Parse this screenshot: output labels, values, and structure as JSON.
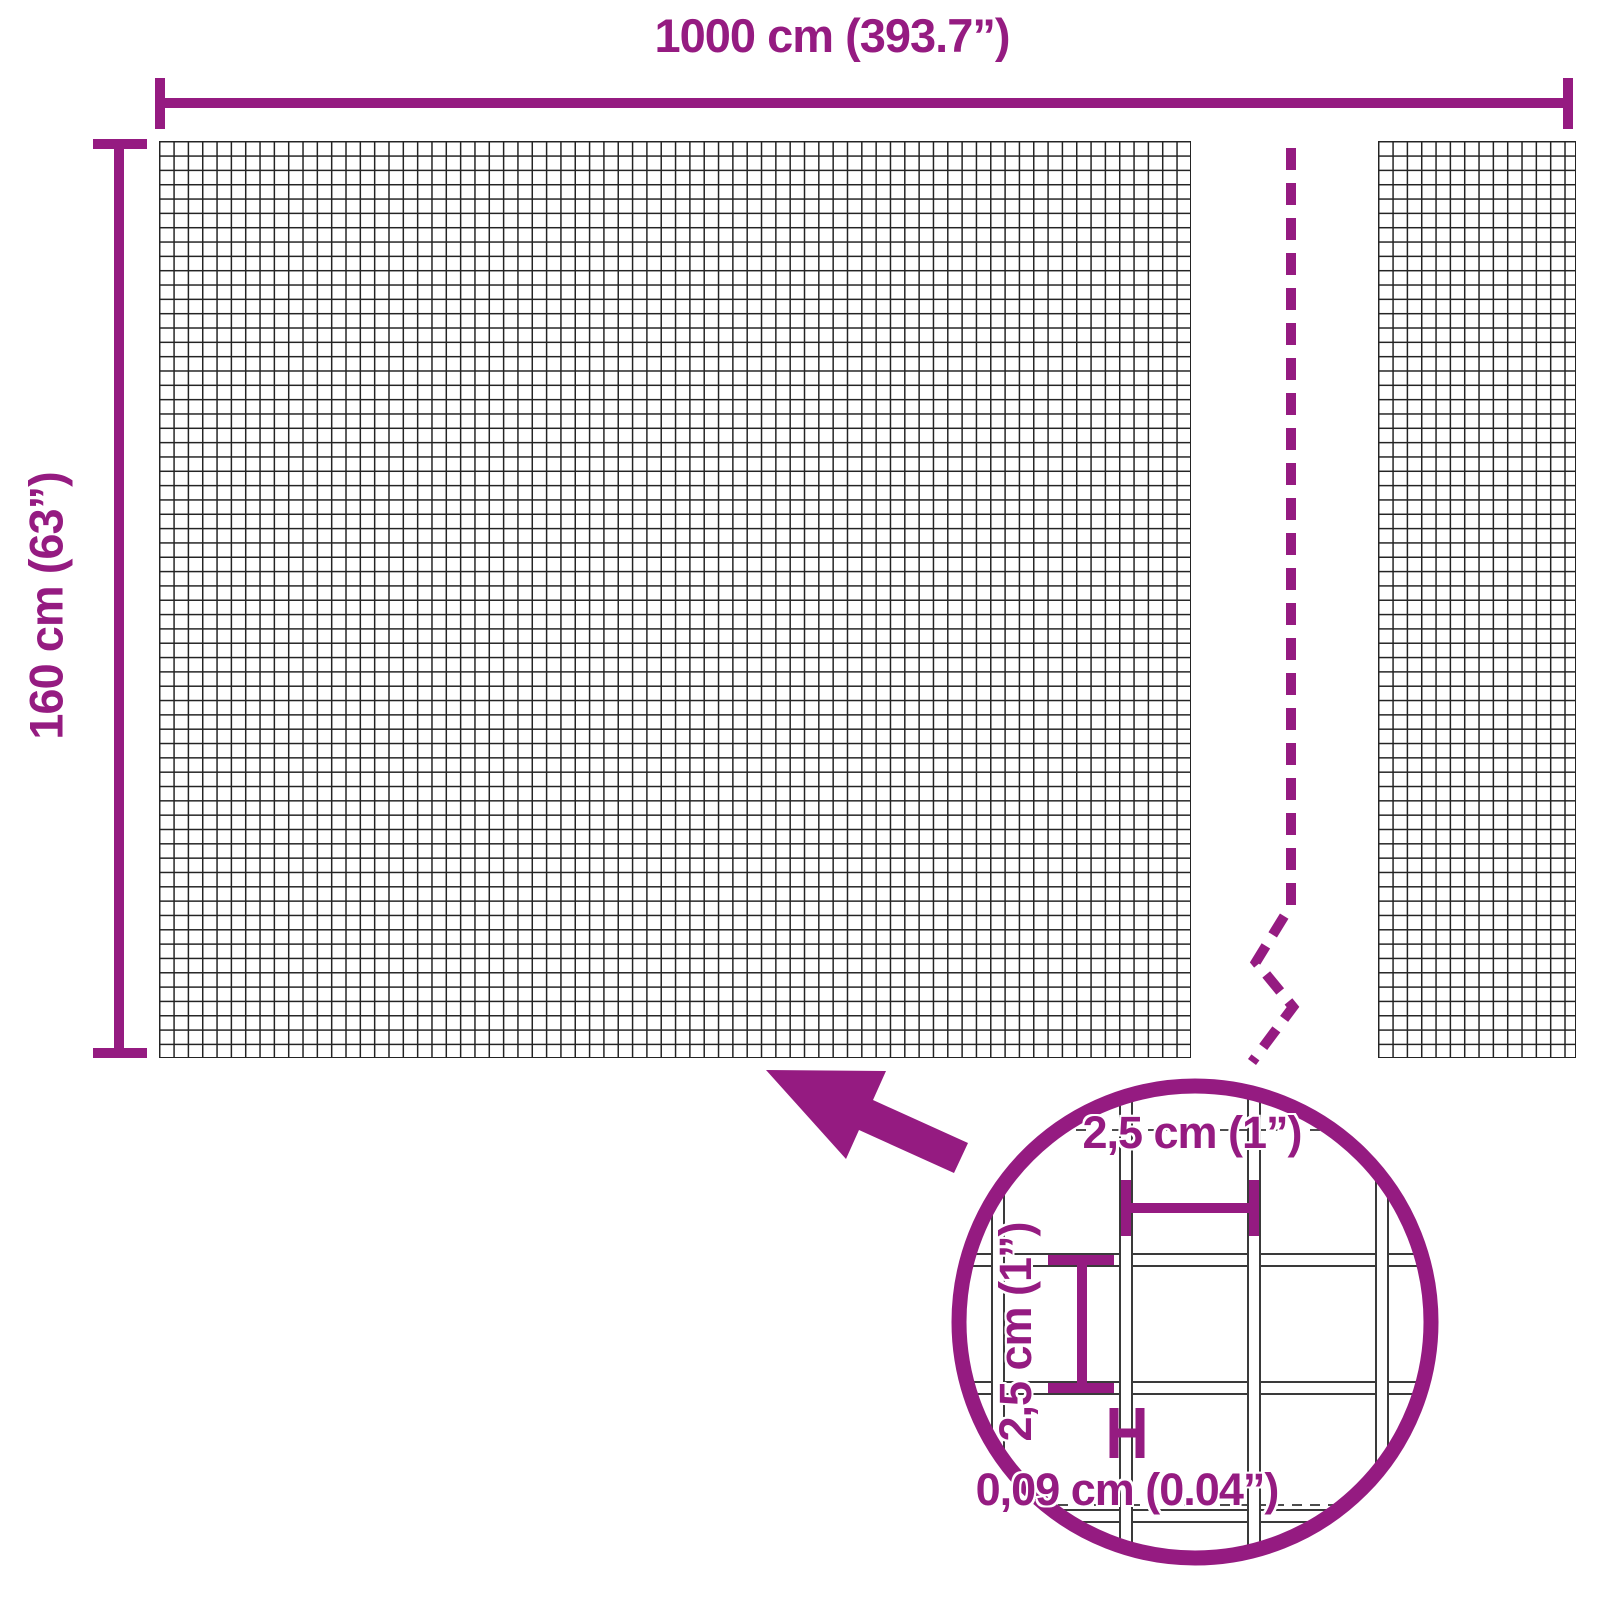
{
  "title": "Wire mesh panel dimension diagram",
  "colors": {
    "accent": "#951B81",
    "mesh": "#242424",
    "wire": "#3a3a3a",
    "guide": "#4d4d4d",
    "background": "#ffffff"
  },
  "overall": {
    "width_label": "1000 cm (393.7”)",
    "height_label": "160 cm (63”)"
  },
  "detail": {
    "cell_width_label": "2,5 cm (1”)",
    "cell_height_label": "2,5 cm (1”)",
    "wire_thickness_label": "0,09 cm (0.04”)"
  },
  "icons": {
    "leader_arrow": "arrow-pointing-up-left",
    "magnifier_circle": "zoom-detail-circle",
    "break_line": "dashed-zigzag-break"
  }
}
